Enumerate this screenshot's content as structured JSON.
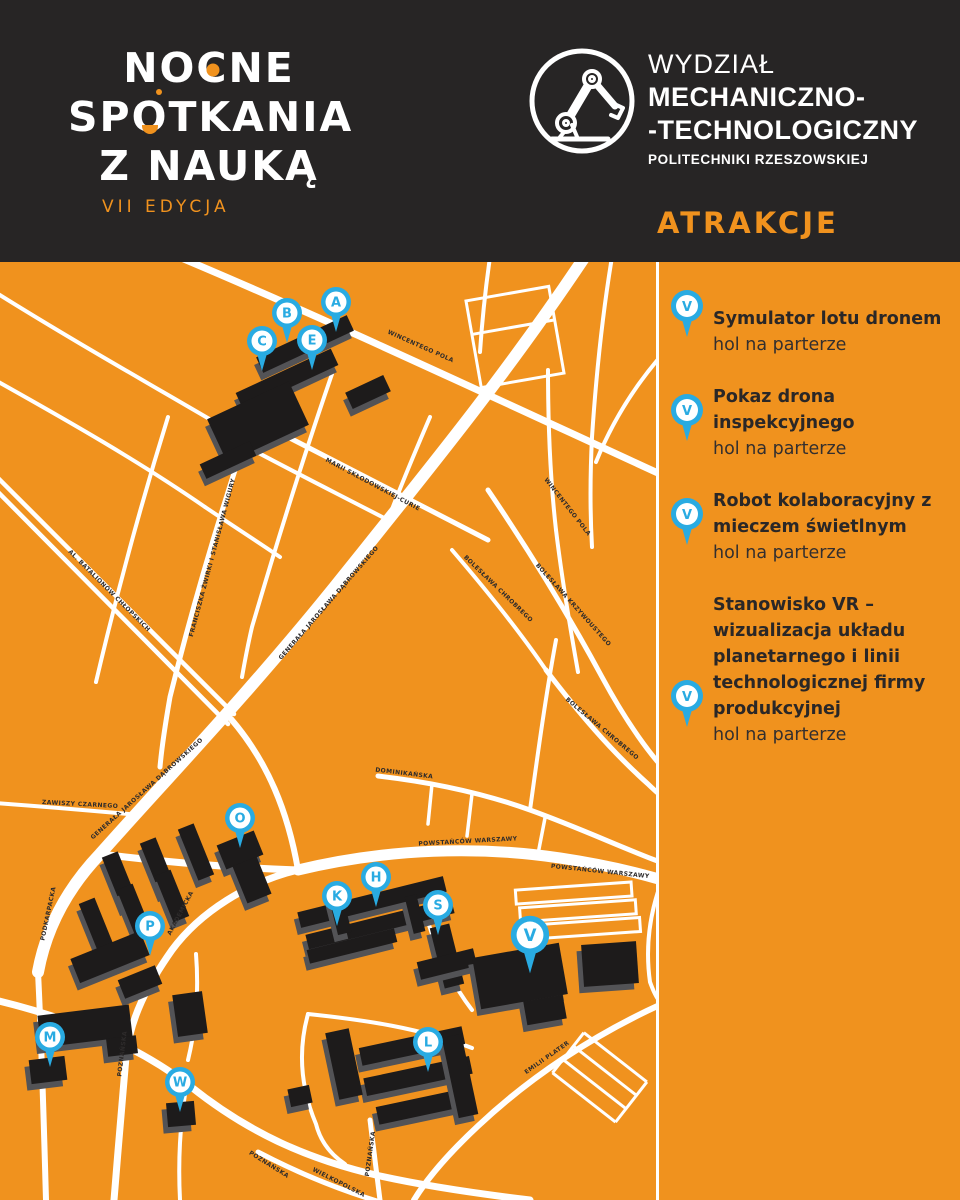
{
  "header": {
    "logo": {
      "line1": "NOCNE",
      "line2": "SPOTKANIA",
      "line3": "Z NAUKĄ",
      "edition": "VII EDYCJA"
    },
    "faculty": {
      "line1": "WYDZIAŁ",
      "line2": "MECHANICZNO-",
      "line3": "-TECHNOLOGICZNY",
      "line4": "POLITECHNIKI RZESZOWSKIEJ"
    },
    "section_label": "ATRAKCJE"
  },
  "colors": {
    "orange": "#F0921E",
    "dark": "#272525",
    "marker_blue": "#29ABE2",
    "street_white": "#FFFFFF",
    "building_black": "#1D1B1B"
  },
  "map": {
    "markers": [
      {
        "letter": "A"
      },
      {
        "letter": "B"
      },
      {
        "letter": "C"
      },
      {
        "letter": "E"
      },
      {
        "letter": "O"
      },
      {
        "letter": "H"
      },
      {
        "letter": "K"
      },
      {
        "letter": "S"
      },
      {
        "letter": "V"
      },
      {
        "letter": "P"
      },
      {
        "letter": "M"
      },
      {
        "letter": "W"
      },
      {
        "letter": "L"
      }
    ],
    "street_labels": [
      "WINCENTEGO POLA",
      "FRANCISZKA ŻWIRKI I STANISŁAWA WIGURY",
      "MARII SKŁODOWSKIEJ-CURIE",
      "WINCENTEGO POLA",
      "BOLESŁAWA CHROBREGO",
      "BOLESŁAWA KRZYWOUSTEGO",
      "BOLESŁAWA CHROBREGO",
      "AL. BATALIONÓW CHŁOPSKICH",
      "GENERAŁA JAROSŁAWA DĄBROWSKIEGO",
      "GENERAŁA JAROSŁAWA DĄBROWSKIEGO",
      "ZAWISZY CZARNEGO",
      "DOMINIKAŃSKA",
      "POWSTAŃCÓW WARSZAWY",
      "POWSTAŃCÓW WARSZAWY",
      "AKADEMICKA",
      "POZNAŃSKA",
      "POZNAŃSKA",
      "POZNAŃSKA",
      "WIELKOPOLSKA",
      "EMILII PLATER",
      "PODKARPACKA"
    ]
  },
  "sidebar": {
    "items": [
      {
        "pin_letter": "V",
        "title": "Symulator lotu dronem",
        "location": "hol na parterze"
      },
      {
        "pin_letter": "V",
        "title": "Pokaz drona inspekcyjnego",
        "location": "hol na parterze"
      },
      {
        "pin_letter": "V",
        "title": "Robot kolaboracyjny z mieczem świetlnym",
        "location": "hol na parterze"
      },
      {
        "pin_letter": "V",
        "title": "Stanowisko VR – wizualizacja układu planetarnego i linii technologicznej firmy produkcyjnej",
        "location": "hol na parterze"
      }
    ]
  }
}
